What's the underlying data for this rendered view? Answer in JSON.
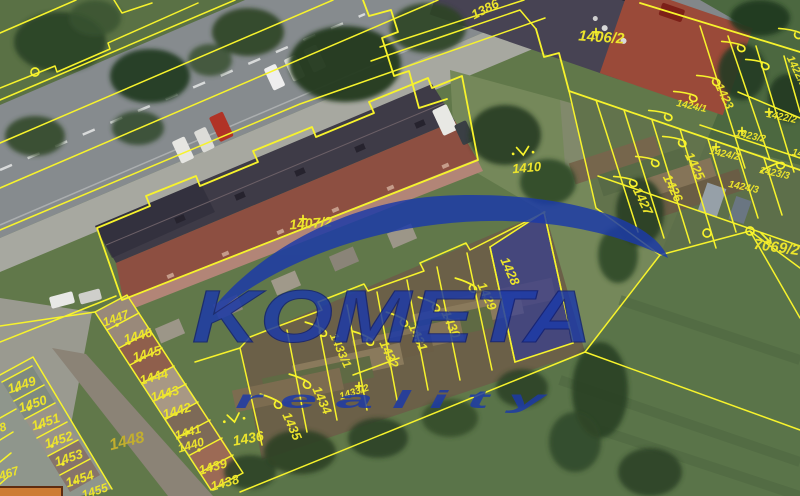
{
  "map": {
    "watermark": {
      "brand": "KOMETA",
      "tagline": "r e a l i t y"
    },
    "selected_parcel": "1428",
    "colors": {
      "line": "#f7f32c",
      "label": "#ece42c",
      "selection_fill": "#2733a8",
      "watermark_blue": "#1c3aa8"
    },
    "labels": [
      {
        "t": "1386",
        "x": 487,
        "y": 13,
        "r": -27,
        "s": 13
      },
      {
        "t": "1406/2",
        "x": 601,
        "y": 42,
        "r": 4,
        "s": 15
      },
      {
        "t": "1410",
        "x": 527,
        "y": 172,
        "r": -5,
        "s": 13
      },
      {
        "t": "1407/2",
        "x": 311,
        "y": 228,
        "r": -4,
        "s": 14
      },
      {
        "t": "1424/1",
        "x": 691,
        "y": 109,
        "r": 12,
        "s": 10
      },
      {
        "t": "1423",
        "x": 721,
        "y": 98,
        "r": 64,
        "s": 12
      },
      {
        "t": "1422/1",
        "x": 794,
        "y": 73,
        "r": 64,
        "s": 11
      },
      {
        "t": "1422/2",
        "x": 781,
        "y": 120,
        "r": 12,
        "s": 10
      },
      {
        "t": "1425",
        "x": 691,
        "y": 168,
        "r": 64,
        "s": 13
      },
      {
        "t": "1424/2",
        "x": 724,
        "y": 157,
        "r": 12,
        "s": 10
      },
      {
        "t": "1423/2",
        "x": 750,
        "y": 139,
        "r": 12,
        "s": 10
      },
      {
        "t": "1423/3",
        "x": 774,
        "y": 176,
        "r": 12,
        "s": 10
      },
      {
        "t": "1424/3",
        "x": 743,
        "y": 190,
        "r": 12,
        "s": 10
      },
      {
        "t": "14",
        "x": 797,
        "y": 156,
        "r": 12,
        "s": 10
      },
      {
        "t": "1426",
        "x": 669,
        "y": 190,
        "r": 64,
        "s": 13
      },
      {
        "t": "1427",
        "x": 639,
        "y": 203,
        "r": 64,
        "s": 13
      },
      {
        "t": "7069/2",
        "x": 776,
        "y": 252,
        "r": 8,
        "s": 15
      },
      {
        "t": "1428",
        "x": 506,
        "y": 273,
        "r": 66,
        "s": 13
      },
      {
        "t": "1429",
        "x": 483,
        "y": 298,
        "r": 66,
        "s": 13
      },
      {
        "t": "1430",
        "x": 447,
        "y": 326,
        "r": 66,
        "s": 13
      },
      {
        "t": "1431",
        "x": 414,
        "y": 339,
        "r": 66,
        "s": 13
      },
      {
        "t": "1432",
        "x": 385,
        "y": 356,
        "r": 66,
        "s": 13
      },
      {
        "t": "1433/1",
        "x": 337,
        "y": 352,
        "r": 66,
        "s": 12
      },
      {
        "t": "1433/2",
        "x": 355,
        "y": 395,
        "r": -18,
        "s": 10
      },
      {
        "t": "1434",
        "x": 318,
        "y": 402,
        "r": 66,
        "s": 13
      },
      {
        "t": "1435",
        "x": 288,
        "y": 428,
        "r": 66,
        "s": 13
      },
      {
        "t": "1436",
        "x": 249,
        "y": 443,
        "r": -10,
        "s": 14
      },
      {
        "t": "1447",
        "x": 117,
        "y": 322,
        "r": -20,
        "s": 12
      },
      {
        "t": "1446",
        "x": 139,
        "y": 340,
        "r": -16,
        "s": 13
      },
      {
        "t": "1445",
        "x": 148,
        "y": 358,
        "r": -16,
        "s": 13
      },
      {
        "t": "1444",
        "x": 155,
        "y": 381,
        "r": -16,
        "s": 13
      },
      {
        "t": "1443",
        "x": 166,
        "y": 398,
        "r": -16,
        "s": 13
      },
      {
        "t": "1442",
        "x": 178,
        "y": 415,
        "r": -16,
        "s": 13
      },
      {
        "t": "1441",
        "x": 189,
        "y": 436,
        "r": -16,
        "s": 12
      },
      {
        "t": "1440",
        "x": 192,
        "y": 449,
        "r": -16,
        "s": 12
      },
      {
        "t": "1439",
        "x": 214,
        "y": 471,
        "r": -16,
        "s": 13
      },
      {
        "t": "1438",
        "x": 226,
        "y": 487,
        "r": -16,
        "s": 13
      },
      {
        "t": "1449",
        "x": 23,
        "y": 389,
        "r": -18,
        "s": 13
      },
      {
        "t": "1450",
        "x": 34,
        "y": 408,
        "r": -18,
        "s": 13
      },
      {
        "t": "1451",
        "x": 47,
        "y": 426,
        "r": -18,
        "s": 13
      },
      {
        "t": "1452",
        "x": 60,
        "y": 444,
        "r": -18,
        "s": 13
      },
      {
        "t": "1453",
        "x": 70,
        "y": 462,
        "r": -18,
        "s": 13
      },
      {
        "t": "1454",
        "x": 81,
        "y": 483,
        "r": -18,
        "s": 13
      },
      {
        "t": "1455",
        "x": 96,
        "y": 495,
        "r": -18,
        "s": 12
      },
      {
        "t": "1448",
        "x": 128,
        "y": 446,
        "r": -14,
        "s": 16,
        "c": "dim"
      },
      {
        "t": "8",
        "x": 4,
        "y": 431,
        "r": -18,
        "s": 12
      },
      {
        "t": "467",
        "x": 10,
        "y": 477,
        "r": -18,
        "s": 12
      }
    ],
    "symbols": [
      {
        "k": "hook",
        "x": 733,
        "y": 43,
        "r": 60
      },
      {
        "k": "hook",
        "x": 790,
        "y": 30,
        "r": 60
      },
      {
        "k": "hook",
        "x": 757,
        "y": 61,
        "r": 60
      },
      {
        "k": "hook",
        "x": 708,
        "y": 77,
        "r": 60
      },
      {
        "k": "hook",
        "x": 685,
        "y": 93,
        "r": 60
      },
      {
        "k": "hook",
        "x": 660,
        "y": 112,
        "r": 60
      },
      {
        "k": "hook",
        "x": 674,
        "y": 138,
        "r": 60
      },
      {
        "k": "hook",
        "x": 647,
        "y": 158,
        "r": 60
      },
      {
        "k": "hook",
        "x": 625,
        "y": 178,
        "r": 60
      },
      {
        "k": "hook",
        "x": 771,
        "y": 166,
        "r": 25
      },
      {
        "k": "hook",
        "x": 466,
        "y": 282,
        "r": 72
      },
      {
        "k": "hook",
        "x": 429,
        "y": 301,
        "r": 72
      },
      {
        "k": "hook",
        "x": 397,
        "y": 316,
        "r": 72
      },
      {
        "k": "hook",
        "x": 363,
        "y": 335,
        "r": 72
      },
      {
        "k": "hook",
        "x": 316,
        "y": 326,
        "r": 72
      },
      {
        "k": "hook",
        "x": 300,
        "y": 378,
        "r": 72
      },
      {
        "k": "hook",
        "x": 271,
        "y": 398,
        "r": 72
      },
      {
        "k": "vdots",
        "x": 523,
        "y": 152,
        "r": -5
      },
      {
        "k": "vdots",
        "x": 234,
        "y": 419,
        "r": -10
      },
      {
        "k": "circle",
        "x": 35,
        "y": 72,
        "r": 0
      },
      {
        "k": "circle",
        "x": 707,
        "y": 233,
        "r": 0
      },
      {
        "k": "circle",
        "x": 750,
        "y": 231,
        "r": 0
      },
      {
        "k": "arrow",
        "x": 766,
        "y": 238,
        "r": 0
      },
      {
        "k": "plus",
        "x": 596,
        "y": 32,
        "r": 0
      },
      {
        "k": "plus",
        "x": 303,
        "y": 219,
        "r": 0
      },
      {
        "k": "plus",
        "x": 769,
        "y": 112,
        "r": 0
      },
      {
        "k": "plus",
        "x": 742,
        "y": 131,
        "r": 0
      },
      {
        "k": "plus",
        "x": 716,
        "y": 147,
        "r": 0
      },
      {
        "k": "plus",
        "x": 359,
        "y": 386,
        "r": 0
      },
      {
        "k": "dot",
        "x": 117,
        "y": 325,
        "r": 0
      },
      {
        "k": "dot",
        "x": 129,
        "y": 343,
        "r": 0
      },
      {
        "k": "dot",
        "x": 140,
        "y": 360,
        "r": 0
      },
      {
        "k": "dot",
        "x": 152,
        "y": 378,
        "r": 0
      },
      {
        "k": "dot",
        "x": 164,
        "y": 396,
        "r": 0
      },
      {
        "k": "dot",
        "x": 176,
        "y": 414,
        "r": 0
      },
      {
        "k": "dot",
        "x": 188,
        "y": 432,
        "r": 0
      },
      {
        "k": "dot",
        "x": 199,
        "y": 450,
        "r": 0
      },
      {
        "k": "dot",
        "x": 211,
        "y": 467,
        "r": 0
      },
      {
        "k": "dot",
        "x": 17,
        "y": 390,
        "r": 0
      },
      {
        "k": "dot",
        "x": 29,
        "y": 409,
        "r": 0
      },
      {
        "k": "dot",
        "x": 40,
        "y": 427,
        "r": 0
      },
      {
        "k": "dot",
        "x": 52,
        "y": 446,
        "r": 0
      },
      {
        "k": "dot",
        "x": 63,
        "y": 464,
        "r": 0
      },
      {
        "k": "dot",
        "x": 75,
        "y": 482,
        "r": 0
      }
    ]
  }
}
